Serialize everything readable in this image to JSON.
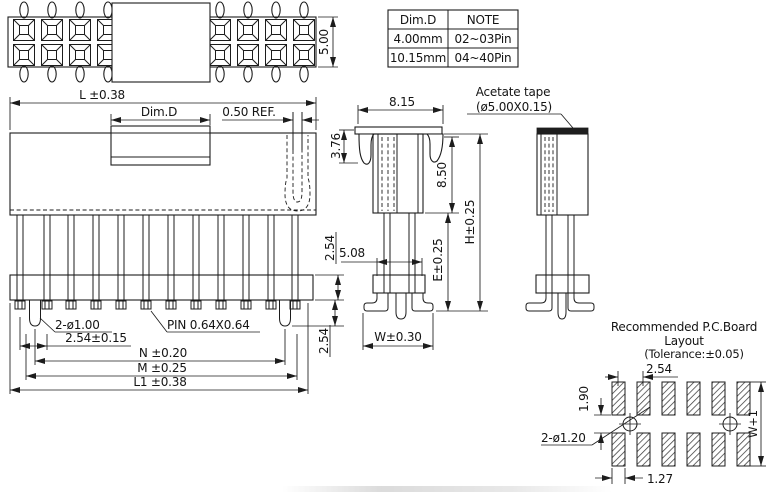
{
  "top_view": {
    "height": "5.00"
  },
  "table": {
    "col1_header": "Dim.D",
    "col2_header": "NOTE",
    "rows": [
      {
        "dim": "4.00mm",
        "note": "02~03Pin"
      },
      {
        "dim": "10.15mm",
        "note": "04~40Pin"
      }
    ]
  },
  "front_view": {
    "overall": "L ±0.38",
    "tape_width": "Dim.D",
    "ref": "0.50 REF.",
    "pitch_v_upper": "2.54",
    "pitch_v_lower": "2.54",
    "peg": "2-ø1.00",
    "pin": "PIN 0.64X0.64",
    "pitch": "2.54±0.15",
    "n": "N ±0.20",
    "m": "M ±0.25",
    "l1": "L1 ±0.38"
  },
  "side_view": {
    "top_width": "8.15",
    "latch": "3.76",
    "body_depth": "8.50",
    "height": "H±0.25",
    "leg_span": "5.08",
    "e": "E±0.25",
    "w": "W±0.30"
  },
  "tape_view": {
    "label1": "Acetate tape",
    "label2": "(ø5.00X0.15)"
  },
  "pcb": {
    "title1": "Recommended P.C.Board",
    "title2": "Layout",
    "title3": "(Tolerance:±0.05)",
    "pitch": "2.54",
    "row_gap": "1.90",
    "holes": "2-ø1.20",
    "w1": "W+1",
    "pad_w": "1.27"
  }
}
